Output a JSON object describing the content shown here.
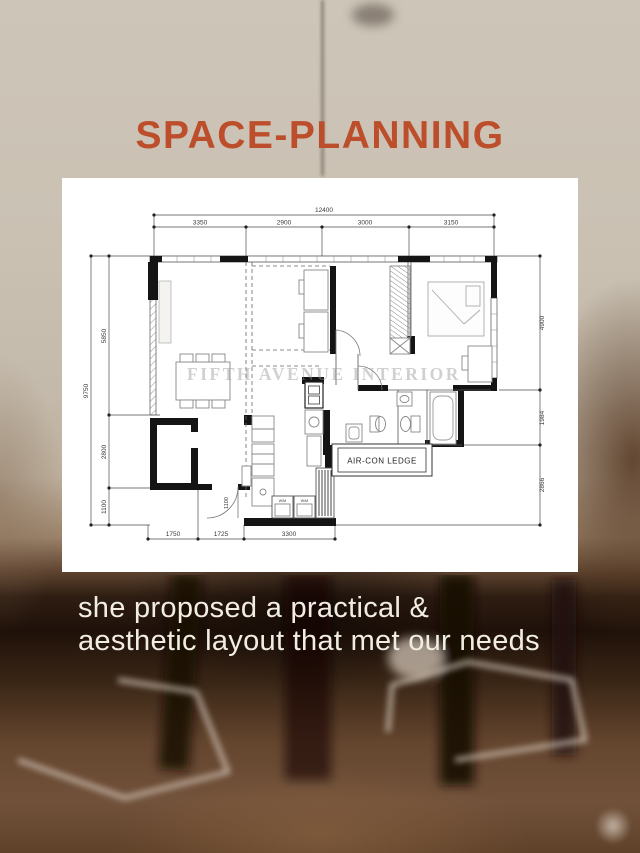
{
  "title": "SPACE-PLANNING",
  "caption": {
    "line1": "she proposed a practical &",
    "line2": "aesthetic layout that met our needs"
  },
  "floor_plan": {
    "watermark": "FIFTH AVENUE INTERIOR",
    "aircon_label": "AIR-CON LEDGE",
    "wm_label_1": "W/M",
    "wm_label_2": "W/M",
    "dimensions": {
      "top_total": "12400",
      "top_segments": [
        "3350",
        "2900",
        "3000",
        "3150"
      ],
      "left_total": "9750",
      "left_segments": [
        "5850",
        "2800",
        "1100"
      ],
      "right_segments": [
        "4900",
        "1984",
        "2866"
      ],
      "bottom_segments": [
        "1750",
        "1725",
        "3300"
      ],
      "entrance_width": "1100"
    }
  },
  "colors": {
    "title_accent": "#bd4e2b",
    "card_background": "#ffffff",
    "caption_text": "#f2ede3",
    "wall_ink": "#141414"
  }
}
